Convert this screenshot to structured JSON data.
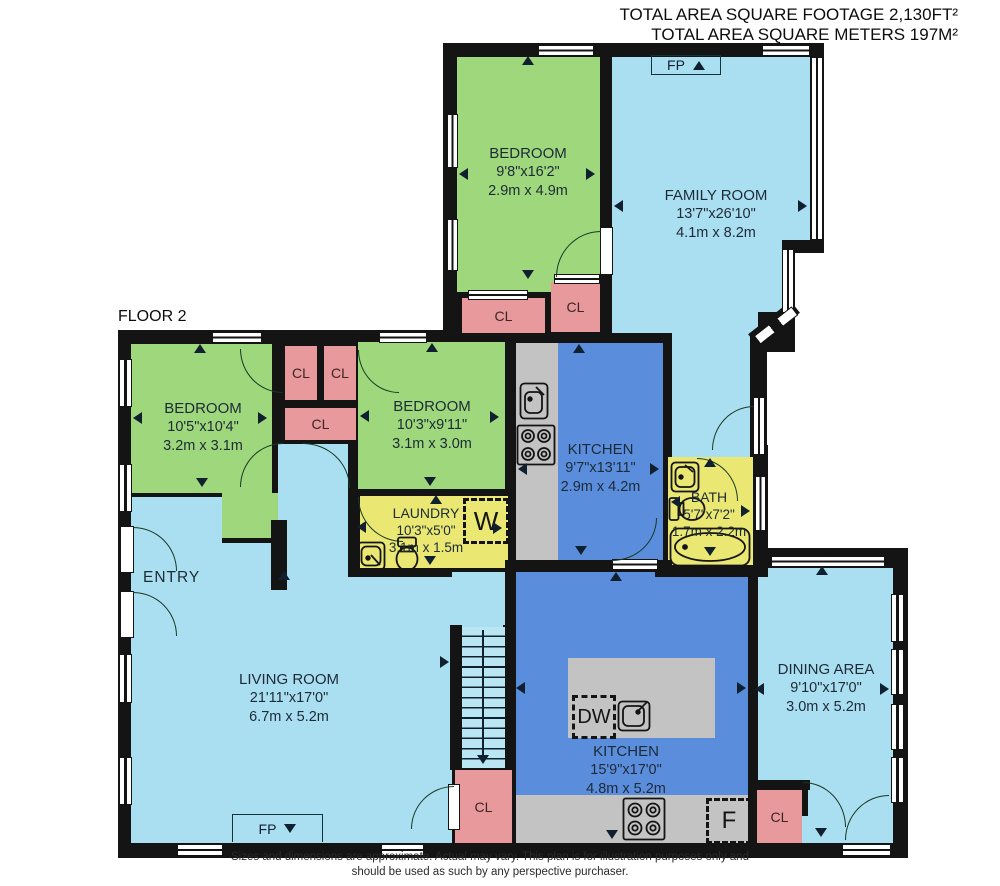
{
  "header": {
    "line1": "TOTAL AREA SQUARE FOOTAGE 2,130FT²",
    "line2": "TOTAL AREA SQUARE METERS 197M²"
  },
  "floor_label": "FLOOR 2",
  "rooms": {
    "bedroom_top": {
      "name": "BEDROOM",
      "imperial": "9'8\"x16'2\"",
      "metric": "2.9m x 4.9m"
    },
    "family_room": {
      "name": "FAMILY ROOM",
      "imperial": "13'7\"x26'10\"",
      "metric": "4.1m x 8.2m"
    },
    "bedroom_left": {
      "name": "BEDROOM",
      "imperial": "10'5\"x10'4\"",
      "metric": "3.2m x 3.1m"
    },
    "bedroom_mid": {
      "name": "BEDROOM",
      "imperial": "10'3\"x9'11\"",
      "metric": "3.1m x 3.0m"
    },
    "kitchen_upper": {
      "name": "KITCHEN",
      "imperial": "9'7\"x13'11\"",
      "metric": "2.9m x 4.2m"
    },
    "bath": {
      "name": "BATH",
      "imperial": "5'7\"x7'2\"",
      "metric": "1.7m x 2.2m"
    },
    "laundry": {
      "name": "LAUNDRY",
      "imperial": "10'3\"x5'0\"",
      "metric": "3.1m x 1.5m"
    },
    "entry": {
      "name": "ENTRY"
    },
    "living_room": {
      "name": "LIVING ROOM",
      "imperial": "21'11\"x17'0\"",
      "metric": "6.7m x 5.2m"
    },
    "kitchen_lower": {
      "name": "KITCHEN",
      "imperial": "15'9\"x17'0\"",
      "metric": "4.8m x 5.2m"
    },
    "dining_area": {
      "name": "DINING AREA",
      "imperial": "9'10\"x17'0\"",
      "metric": "3.0m x 5.2m"
    }
  },
  "labels": {
    "closet": "CL",
    "fireplace": "FP",
    "washer": "W",
    "dishwasher": "DW",
    "fridge": "F"
  },
  "footer": {
    "line1": "Sizes and dimensions are approximate. Actual may vary. This plan is for illustration purposes only and",
    "line2": "should be used as such by any perspective purchaser."
  },
  "colors": {
    "bedroom_green": "#9fd77d",
    "living_blue": "#aadef1",
    "kitchen_blue": "#5b8ddd",
    "wet_room_yellow": "#eae772",
    "closet_pink": "#e8999c",
    "counter_gray": "#c3c3c3",
    "wall_black": "#141414"
  }
}
